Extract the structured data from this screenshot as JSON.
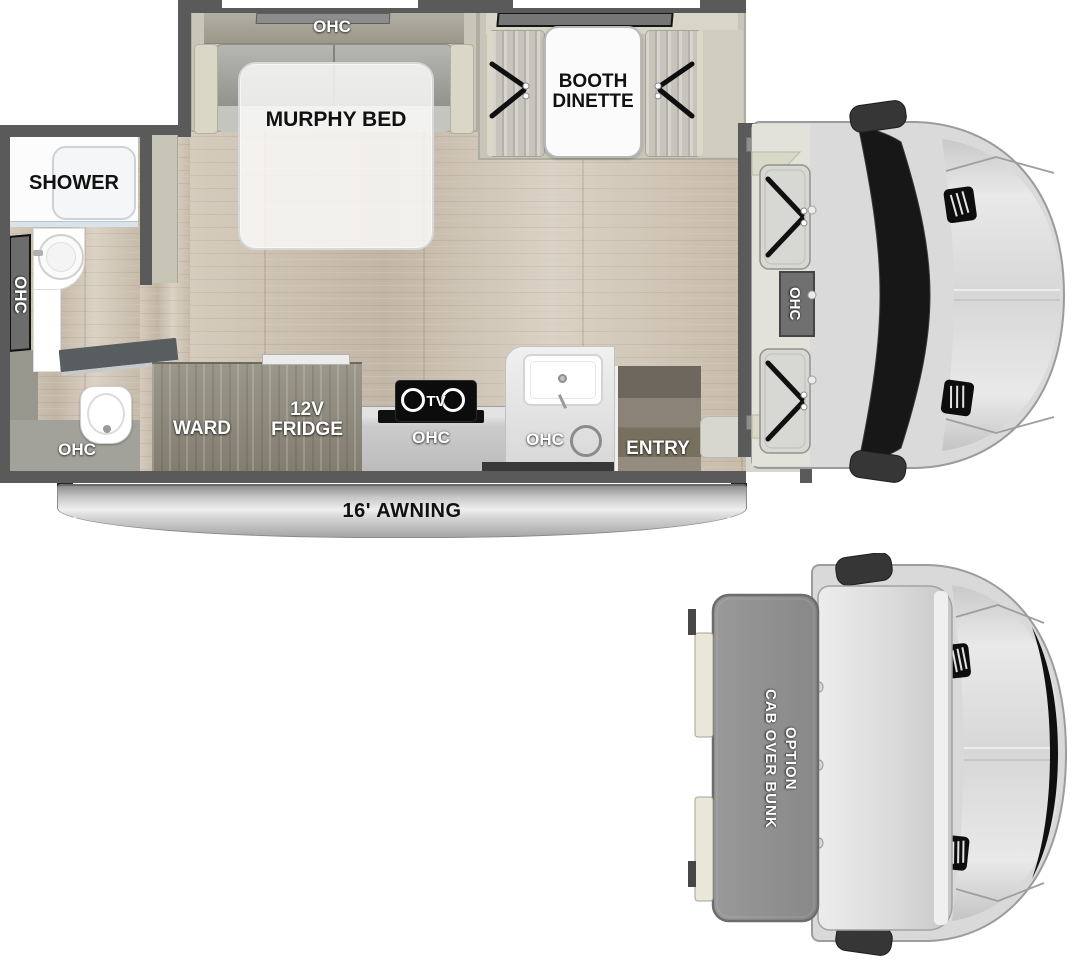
{
  "figure": {
    "type": "rv-floorplan-top-view",
    "views": [
      "main floorplan",
      "cab over bunk option"
    ]
  },
  "main_floorplan": {
    "bedroom": {
      "overhead_cabinet": "OHC",
      "bed": "MURPHY BED"
    },
    "dinette": {
      "table": "BOOTH DINETTE"
    },
    "bathroom": {
      "shower": "SHOWER",
      "wall_cabinet": "OHC",
      "floor_cabinet": "OHC"
    },
    "kitchen": {
      "wardrobe": "WARD",
      "refrigerator": "12V FRIDGE",
      "tv": "TV",
      "counter_cabinet": "OHC",
      "sink_cabinet": "OHC"
    },
    "entry": {
      "label": "ENTRY"
    },
    "awning": {
      "label": "16' AWNING"
    },
    "cab": {
      "overhead_cabinet": "OHC"
    }
  },
  "bunk_view": {
    "label_line1": "CAB OVER BUNK",
    "label_line2": "OPTION"
  },
  "colors": {
    "wall": "#5a5a5a",
    "wood_floor": "#cdc3b3",
    "cabinet_wood": "#8e8a7e",
    "slide_trim": "#c8c6b8",
    "label_white": "#ffffff",
    "label_black": "#111111",
    "windshield": "#161616",
    "cab_body": "#d9d9d9",
    "bunk": "#8f8f8f",
    "awning_silver": "#c7c7c7"
  }
}
